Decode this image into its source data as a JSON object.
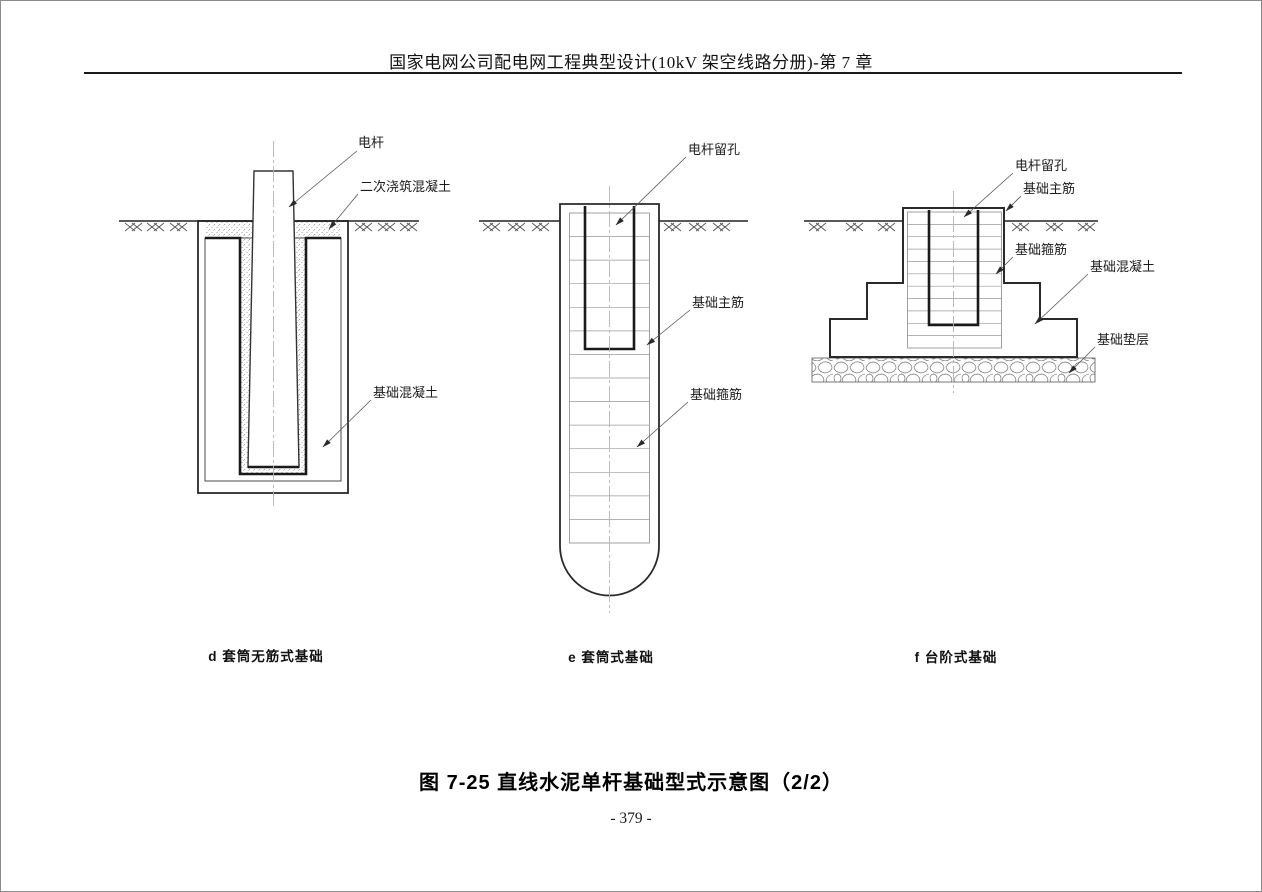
{
  "page": {
    "header": "国家电网公司配电网工程典型设计(10kV 架空线路分册)-第 7 章",
    "figure_caption": "图 7-25  直线水泥单杆基础型式示意图（2/2）",
    "page_number": "- 379 -"
  },
  "diagrams": {
    "d": {
      "caption": "d  套筒无筋式基础",
      "labels": {
        "pole": "电杆",
        "secondary_concrete": "二次浇筑混凝土",
        "foundation_concrete": "基础混凝土"
      }
    },
    "e": {
      "caption": "e  套筒式基础",
      "labels": {
        "pole_hole": "电杆留孔",
        "main_rebar": "基础主筋",
        "stirrup": "基础箍筋"
      }
    },
    "f": {
      "caption": "f  台阶式基础",
      "labels": {
        "pole_hole": "电杆留孔",
        "main_rebar": "基础主筋",
        "stirrup": "基础箍筋",
        "foundation_concrete": "基础混凝土",
        "cushion": "基础垫层"
      }
    }
  },
  "colors": {
    "outline": "#2a2a2a",
    "heavy_line": "#1a1a1a",
    "light_line": "#9a9a9a",
    "stipple_dot": "#8a8a8a",
    "text": "#111111"
  }
}
